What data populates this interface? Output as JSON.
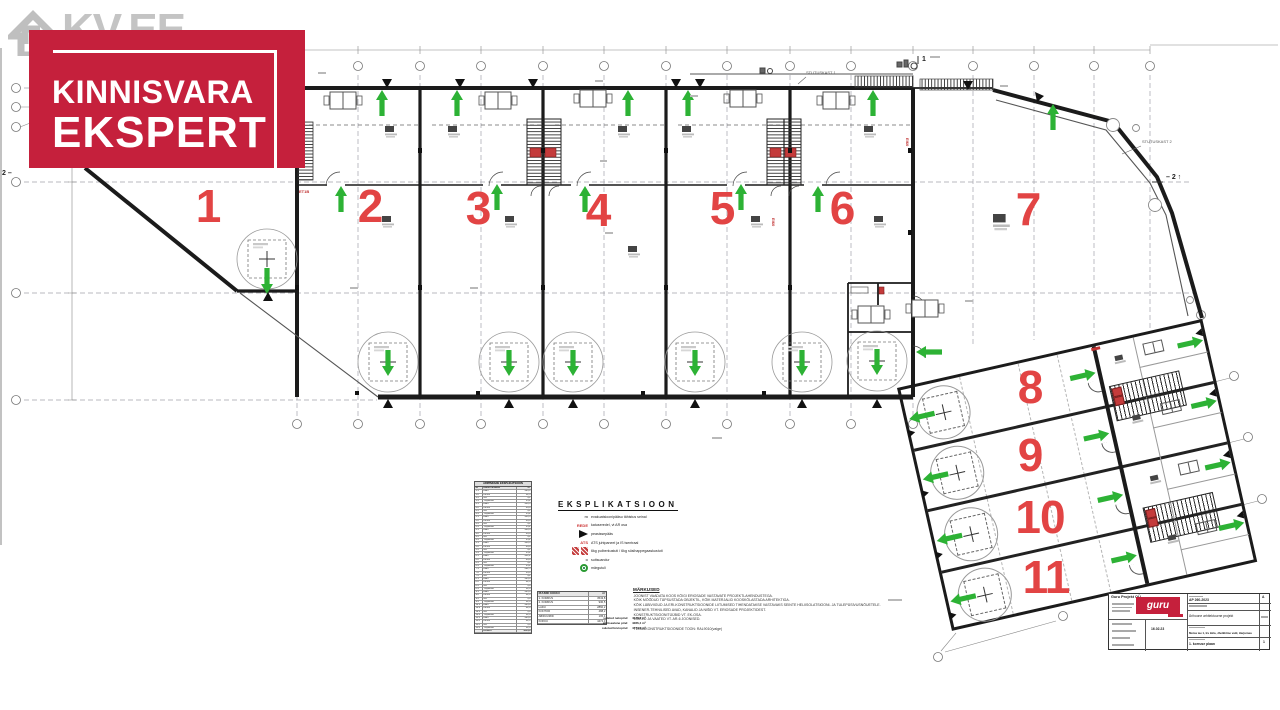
{
  "watermark": {
    "text": "KV.EE"
  },
  "logo": {
    "line1": "KINNISVARA",
    "line2": "EKSPERT",
    "brand_red": "#c5203c"
  },
  "plan": {
    "units": [
      "1",
      "2",
      "3",
      "4",
      "5",
      "6",
      "7",
      "8",
      "9",
      "10",
      "11"
    ],
    "number_color": "#e24444",
    "arrow_color": "#2db235",
    "labels": {
      "duct1": "STUTUSKAST 1",
      "duct2": "STUTUSKAST 2",
      "section_right": "– 2 ↑",
      "section_left": "2 –",
      "section_top": "1",
      "fire1": "ET1B",
      "fire2": "EI60",
      "fire3": "EI60"
    }
  },
  "legend": {
    "title": "EKSPLIKATSIOON",
    "items": [
      {
        "sym": "m",
        "text": "evakuatsioonipääsu tähistus seinal"
      },
      {
        "sym": "REDE",
        "text": "katuseredel, vt AR osa"
      },
      {
        "sym": "",
        "text": "peasissepääs"
      },
      {
        "sym": "ATS",
        "text": "ATS juhtpaneel ja IS tsentraal"
      },
      {
        "sym": "",
        "text": "6kg pulberkustuti / 6kg süsihappegaaskustuti"
      },
      {
        "sym": "o",
        "text": "suitsuandur"
      },
      {
        "sym": "",
        "text": "märgutuli"
      }
    ]
  },
  "expl_table": {
    "title": "ÄRIPINDADE EKSPLIKATSIOON",
    "rows": [
      [
        "Nr",
        "Ruumi nimetus",
        "m²"
      ],
      [
        "1.1",
        "Ladu",
        "286,4"
      ],
      [
        "1.2",
        "Kontor",
        "52,3"
      ],
      [
        "1.3",
        "WC",
        "4,1"
      ],
      [
        "1.4",
        "Trepikoda",
        "13,2"
      ],
      [
        "2.1",
        "Ladu",
        "248,6"
      ],
      [
        "2.2",
        "Kontor",
        "49,8"
      ],
      [
        "2.3",
        "WC",
        "4,1"
      ],
      [
        "2.4",
        "Trepikoda",
        "13,2"
      ],
      [
        "3.1",
        "Ladu",
        "248,6"
      ],
      [
        "3.2",
        "Kontor",
        "49,8"
      ],
      [
        "3.3",
        "WC",
        "4,1"
      ],
      [
        "3.4",
        "Trepikoda",
        "13,2"
      ],
      [
        "4.1",
        "Ladu",
        "248,6"
      ],
      [
        "4.2",
        "Kontor",
        "49,8"
      ],
      [
        "4.3",
        "WC",
        "4,1"
      ],
      [
        "4.4",
        "Trepikoda",
        "13,2"
      ],
      [
        "5.1",
        "Ladu",
        "248,6"
      ],
      [
        "5.2",
        "Kontor",
        "49,8"
      ],
      [
        "5.3",
        "WC",
        "4,1"
      ],
      [
        "5.4",
        "Trepikoda",
        "13,2"
      ],
      [
        "6.1",
        "Ladu",
        "251,2"
      ],
      [
        "6.2",
        "Kontor",
        "49,8"
      ],
      [
        "6.3",
        "WC",
        "4,1"
      ],
      [
        "6.4",
        "Trepikoda",
        "13,2"
      ],
      [
        "7.1",
        "Ladu",
        "682,5"
      ],
      [
        "7.2",
        "Kontor",
        "56,4"
      ],
      [
        "7.3",
        "WC",
        "4,1"
      ],
      [
        "8.1",
        "Ladu",
        "226,8"
      ],
      [
        "8.2",
        "Kontor",
        "42,6"
      ],
      [
        "8.3",
        "WC",
        "3,8"
      ],
      [
        "8.4",
        "Trepikoda",
        "12,6"
      ],
      [
        "9.1",
        "Ladu",
        "226,8"
      ],
      [
        "9.2",
        "Kontor",
        "42,6"
      ],
      [
        "9.3",
        "WC",
        "3,8"
      ],
      [
        "9.4",
        "Trepikoda",
        "12,6"
      ],
      [
        "10.1",
        "Ladu",
        "226,8"
      ],
      [
        "10.2",
        "Kontor",
        "42,6"
      ],
      [
        "10.3",
        "WC",
        "3,8"
      ],
      [
        "10.4",
        "Trepikoda",
        "12,6"
      ],
      [
        "11.1",
        "Ladu",
        "226,8"
      ],
      [
        "11.2",
        "Kontor",
        "42,6"
      ],
      [
        "11.3",
        "WC",
        "3,8"
      ],
      [
        "11.4",
        "Trepikoda",
        "12,6"
      ],
      [
        "",
        "KOKKU",
        "4043,8"
      ]
    ]
  },
  "rooms_table": {
    "rows": [
      [
        "RUUMID KOKKU",
        "m²"
      ],
      [
        "1. KORRUS",
        "3543,8"
      ],
      [
        "2. KORRUS",
        "930,5"
      ],
      [
        "LADU",
        "2860,2"
      ],
      [
        "KONTOR",
        "488,2"
      ],
      [
        "ABIRUUMID",
        "195,4"
      ],
      [
        "KOKKU",
        "4474,3"
      ]
    ]
  },
  "summary": {
    "rows": [
      [
        "suletud netopind",
        "4043,8 m²"
      ],
      [
        "ehitisealune pind",
        "4286,4 m²"
      ],
      [
        "suletud brutopind",
        "4474,3 m²"
      ]
    ]
  },
  "notes": {
    "title": "MÄRKUSED",
    "lines": [
      "JOONIST VAADATA KOOS KÕIGI ERIOSADE VASTAVATE PROJEKTLAHENDUSTEGA.",
      "KÕIK MÕÕDUD TÄPSUSTADA OBJEKTIL, KÕIK MATERJALID KOOSKÕLASTADA ARHITEKTIGA.",
      "KÕIK LÄBIVIIGUD JA ERI-KONSTRUKTSIOONIDE LIITUMISED TIHENDATAKSE VASTAVAKS SEINTE HELIISOLATSIOONI- JA TULEPÜSIVUSNÕUETELE.",
      "INSENER-TEHNILISED AVAD, KANALID JA NIŠID VT. ERIOSADE PROJEKTIDEST.",
      "KONSTRUKTSIOONITÜÜBID VT. EK-OSA.",
      "LÕIKED JA VAATED VT. AR-6 JOONISED.",
      "TERASKONSTRUKTSIOONIDE TOON: RAL9010(valge)"
    ]
  },
  "titleblock": {
    "company": "Guru Projekt OÜ",
    "logo": "guru",
    "work_no": "AP 260-2023",
    "date": "16.02.23",
    "project": "Ärihoone arhitektuurne projekt",
    "address": "Metsa tee 1, Iru küla, Jõelähtme vald, Harjumaa",
    "sheet": "1. korruse plaan",
    "rev": "A",
    "page": "1"
  }
}
